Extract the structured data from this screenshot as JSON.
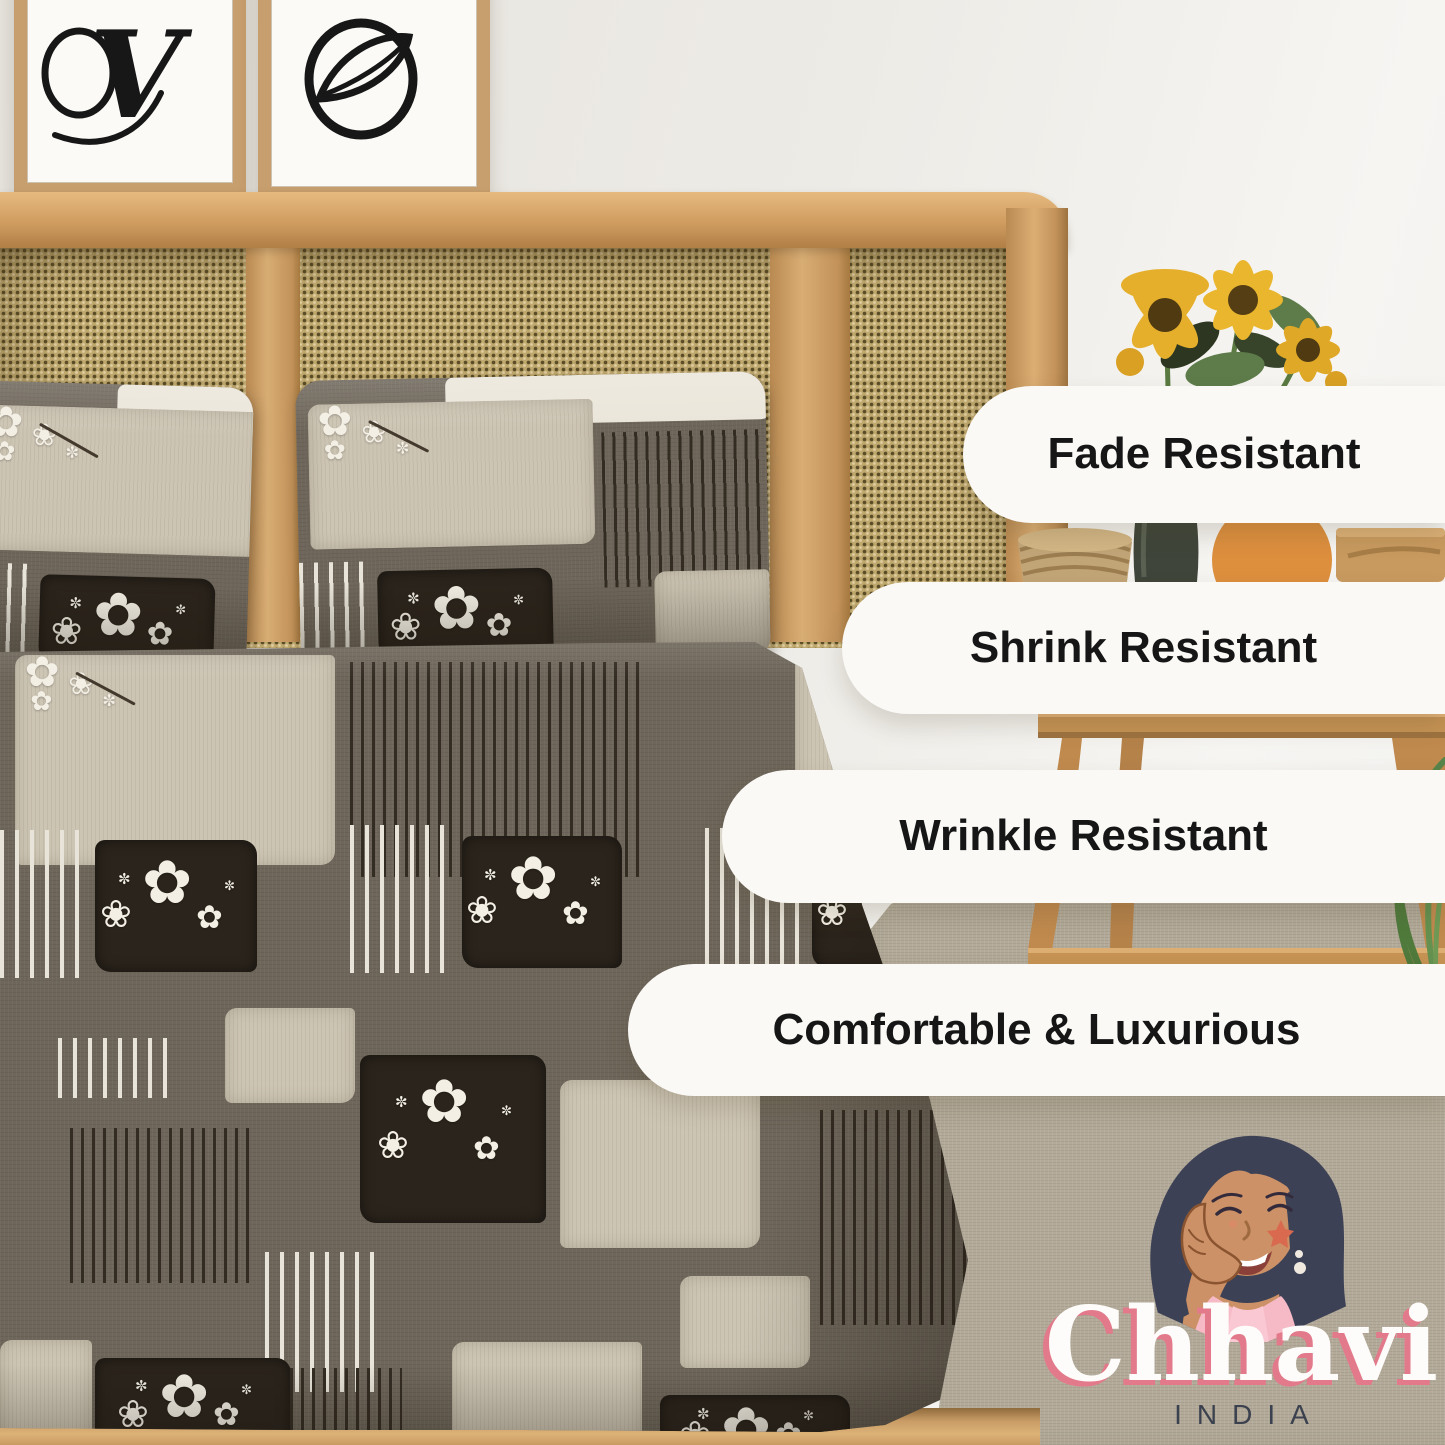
{
  "brand": {
    "name": "Chhavi",
    "country": "INDIA"
  },
  "features": [
    {
      "label": "Fade Resistant"
    },
    {
      "label": "Shrink Resistant"
    },
    {
      "label": "Wrinkle Resistant"
    },
    {
      "label": "Comfortable & Luxurious"
    }
  ],
  "wall_art": {
    "left_glyph": "V"
  },
  "colors": {
    "pill_bg": "#faf9f6",
    "pill_text": "#161616",
    "brand_text": "#fdfcfa",
    "brand_shadow": "#e27a8b",
    "country_text": "#3b414e",
    "sheet_base": "#6e665a",
    "sheet_dark_patch": "#2b241c",
    "rug": "#b3aa99",
    "cane": "#c0a96f"
  }
}
